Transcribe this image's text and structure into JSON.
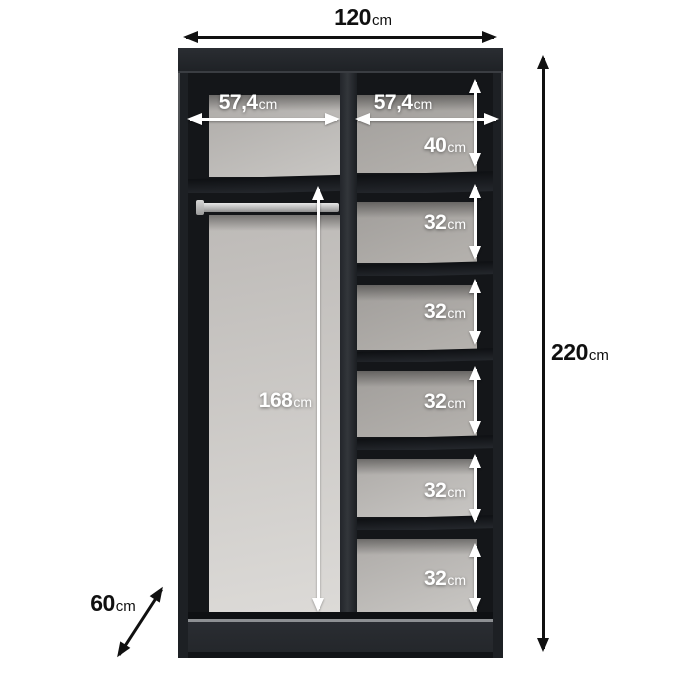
{
  "dimensions": {
    "width": {
      "value": "120",
      "unit": "cm"
    },
    "height": {
      "value": "220",
      "unit": "cm"
    },
    "depth": {
      "value": "60",
      "unit": "cm"
    },
    "left_compartment_width": {
      "value": "57,4",
      "unit": "cm"
    },
    "right_compartment_width": {
      "value": "57,4",
      "unit": "cm"
    },
    "hanging_section_height": {
      "value": "168",
      "unit": "cm"
    }
  },
  "right_compartment_sections": [
    {
      "value": "40",
      "unit": "cm"
    },
    {
      "value": "32",
      "unit": "cm"
    },
    {
      "value": "32",
      "unit": "cm"
    },
    {
      "value": "32",
      "unit": "cm"
    },
    {
      "value": "32",
      "unit": "cm"
    },
    {
      "value": "32",
      "unit": "cm"
    }
  ],
  "colors": {
    "background": "#ffffff",
    "wardrobe_body": "#1d2024",
    "interior_shadow": "#141619",
    "back_panel_gray": "#aba8a5",
    "hanging_panel_gray": "#d0cecb",
    "rail_silver": "#c6c6c6",
    "dimension_arrow_dark": "#101010",
    "dimension_arrow_light": "#ffffff"
  }
}
